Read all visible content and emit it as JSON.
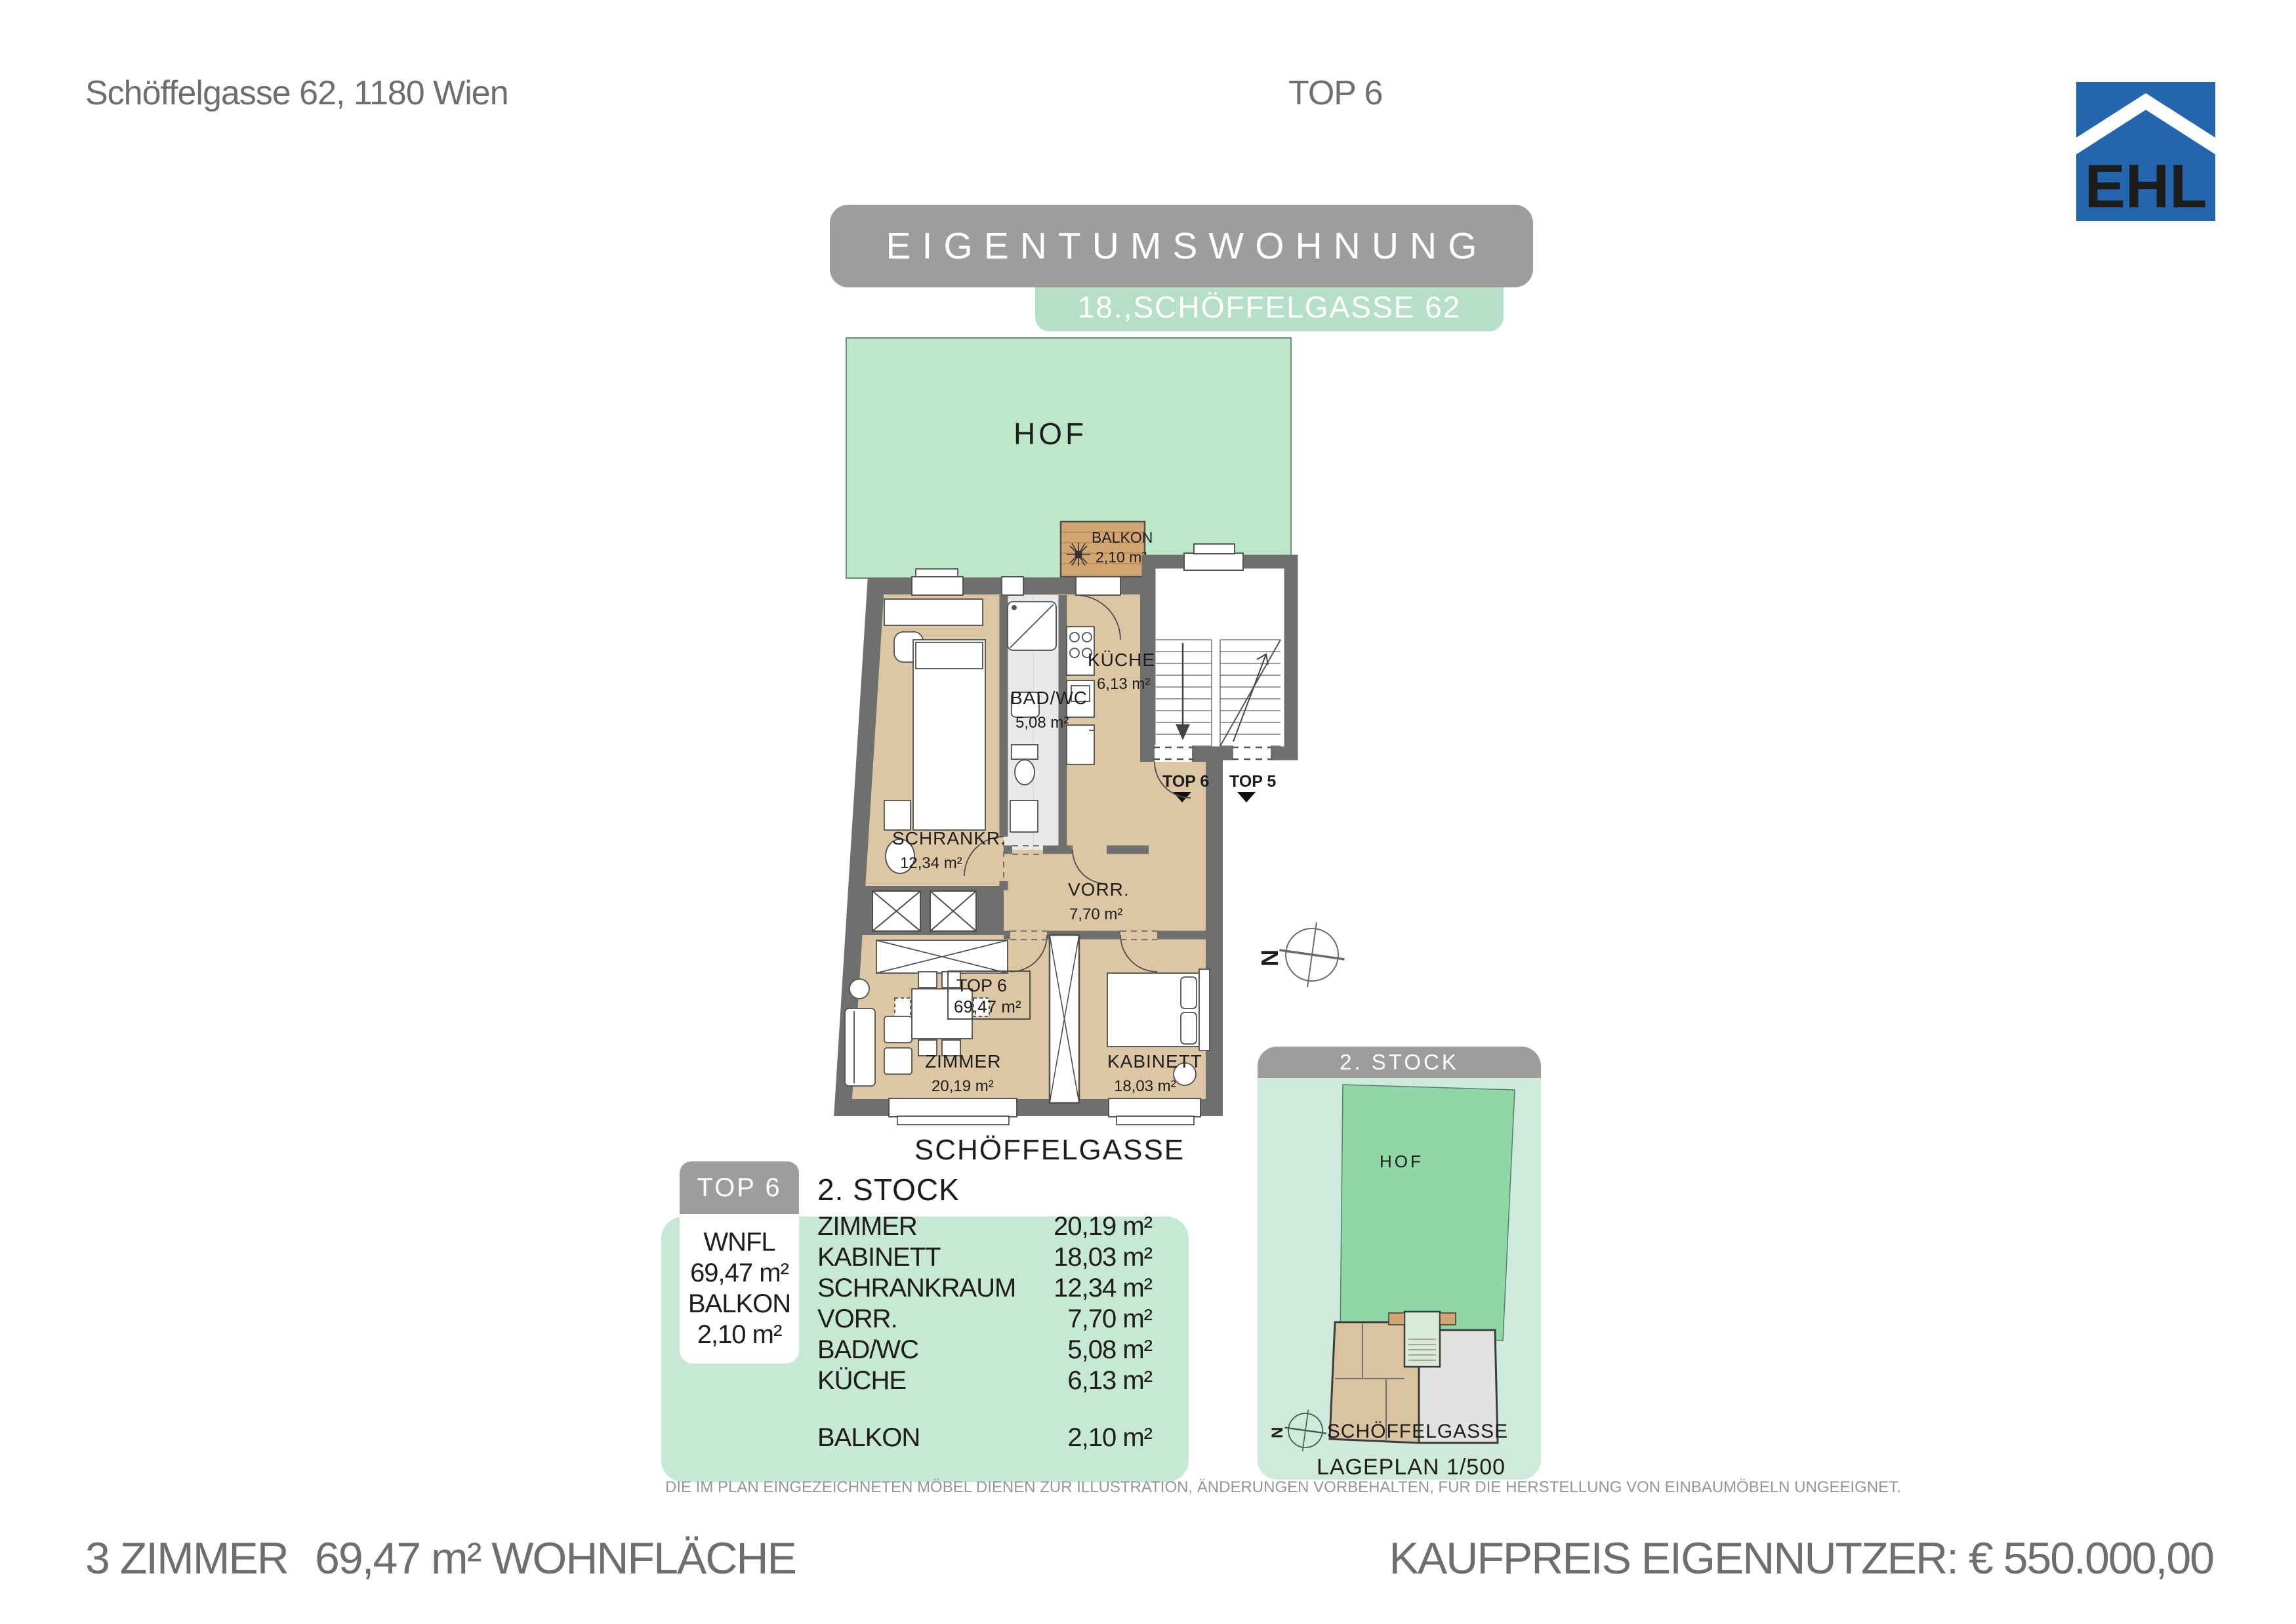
{
  "page": {
    "address": "Schöffelgasse 62, 1180 Wien",
    "top_label": "TOP 6"
  },
  "logo": {
    "text": "EHL",
    "blue": "#2366ad"
  },
  "banner": {
    "title": "EIGENTUMSWOHNUNG",
    "subtitle": "18.,SCHÖFFELGASSE 62",
    "title_bg": "#9d9d9c",
    "subtitle_bg": "#b5dfc8"
  },
  "plan": {
    "hof": "HOF",
    "street": "SCHÖFFELGASSE",
    "balkon": {
      "name": "BALKON",
      "area": "2,10 m²"
    },
    "kueche": {
      "name": "KÜCHE",
      "area": "6,13 m²"
    },
    "bad": {
      "name": "BAD/WC",
      "area": "5,08 m²"
    },
    "schrank": {
      "name": "SCHRANKR.",
      "area": "12,34 m²"
    },
    "vorr": {
      "name": "VORR.",
      "area": "7,70 m²"
    },
    "zimmer": {
      "name": "ZIMMER",
      "area": "20,19 m²"
    },
    "kabinett": {
      "name": "KABINETT",
      "area": "18,03 m²"
    },
    "unit_box": {
      "line1": "TOP 6",
      "line2": "69,47 m²"
    },
    "stair_top6": "TOP 6",
    "stair_top5": "TOP 5",
    "compass_n": "N",
    "hof_green": "#bce8c9",
    "wood": "#dcc6a3",
    "balcony_wood": "#d2a573",
    "wall_gray": "#6f6f6e"
  },
  "minimap": {
    "header": "2. STOCK",
    "hof": "HOF",
    "street": "SCHÖFFELGASSE",
    "scale_label": "LAGEPLAN 1/500",
    "compass_n": "N",
    "hof_green": "#8fd7a6",
    "card_bg": "#cfeadd"
  },
  "summary": {
    "pill": "TOP 6",
    "floor": "2. STOCK",
    "wnfl_label": "WNFL",
    "wnfl_value": "69,47 m²",
    "balkon_label": "BALKON",
    "balkon_value": "2,10 m²",
    "rows": [
      {
        "label": "ZIMMER",
        "value": "20,19 m²"
      },
      {
        "label": "KABINETT",
        "value": "18,03 m²"
      },
      {
        "label": "SCHRANKRAUM",
        "value": "12,34 m²"
      },
      {
        "label": "VORR.",
        "value": "7,70 m²"
      },
      {
        "label": "BAD/WC",
        "value": "5,08 m²"
      },
      {
        "label": "KÜCHE",
        "value": "6,13 m²"
      }
    ],
    "balkon_row": {
      "label": "BALKON",
      "value": "2,10 m²"
    }
  },
  "disclaimer": "DIE IM PLAN EINGEZEICHNETEN MÖBEL DIENEN ZUR ILLUSTRATION, ÄNDERUNGEN VORBEHALTEN, FÜR DIE HERSTELLUNG VON EINBAUMÖBELN UNGEEIGNET.",
  "footer": {
    "rooms": "3 ZIMMER",
    "area": "69,47 m² WOHNFLÄCHE",
    "price": "KAUFPREIS EIGENNUTZER: € 550.000,00"
  }
}
